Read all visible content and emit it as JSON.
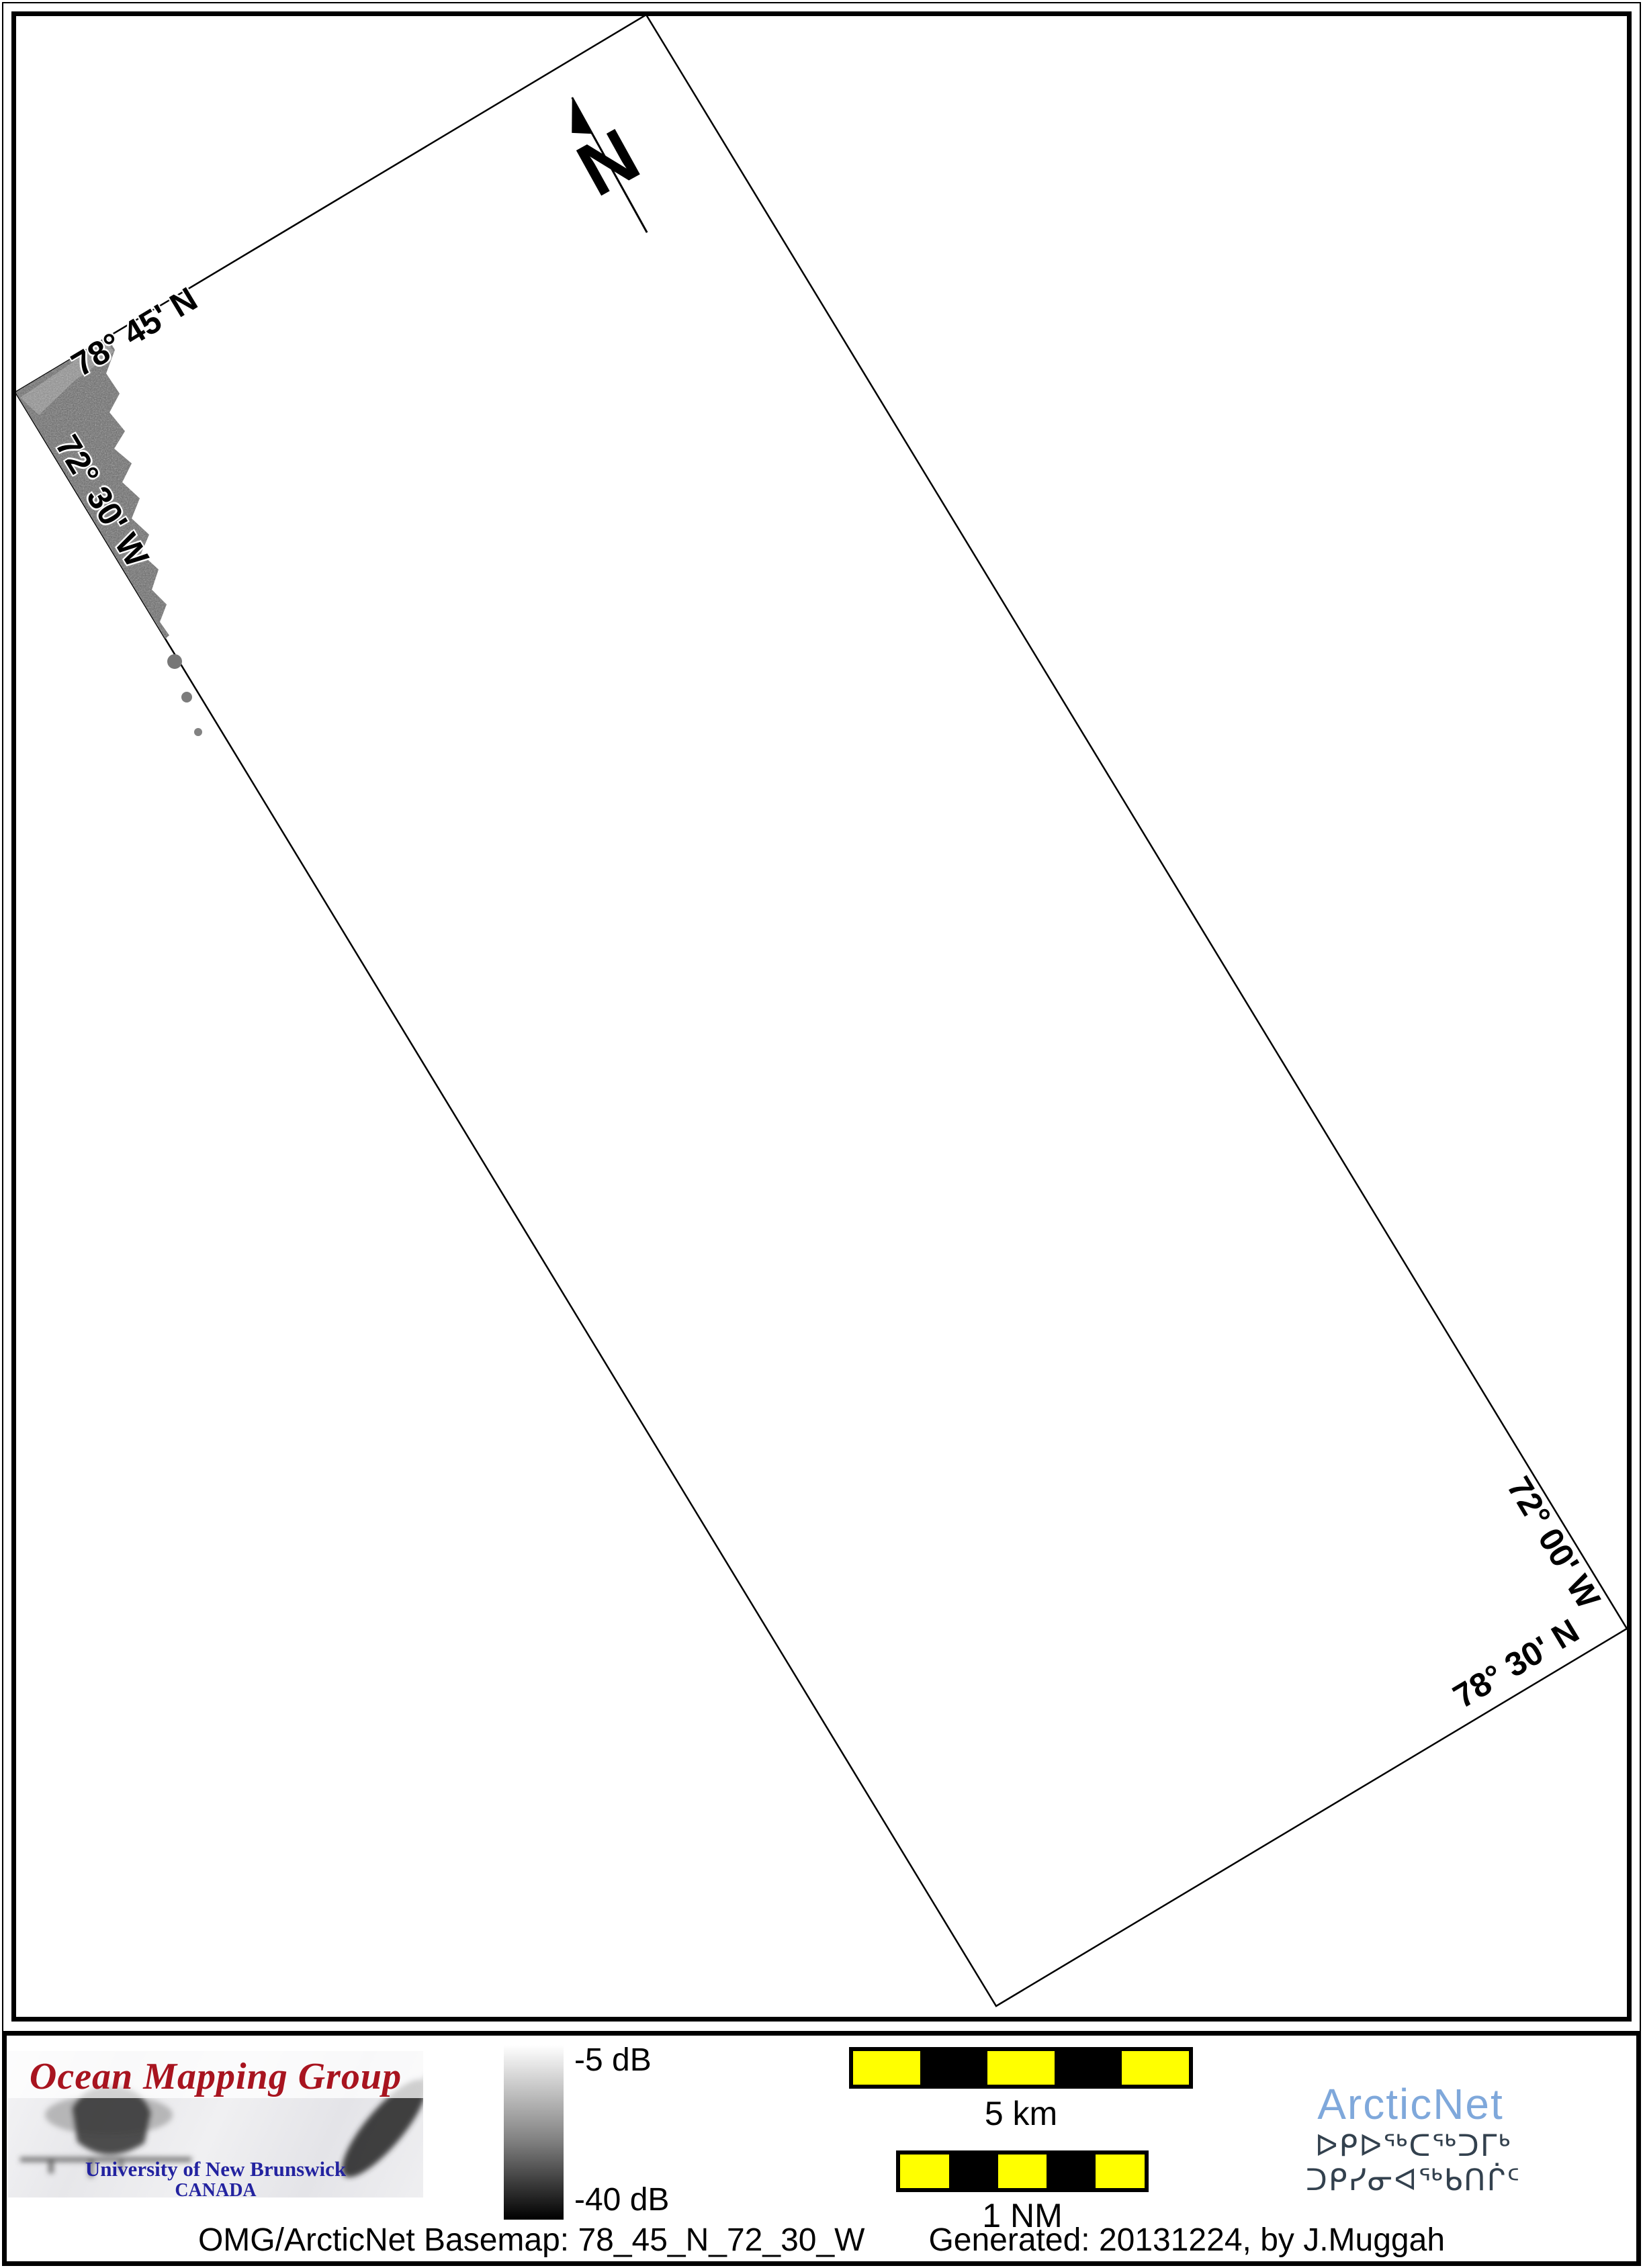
{
  "map": {
    "edge_labels": {
      "top_left_lat": "78° 45' N",
      "top_left_lon": "72° 30' W",
      "bottom_right_lon": "72° 00' W",
      "bottom_right_lat": "78° 30' N"
    },
    "north_arrow_letter": "N"
  },
  "legend": {
    "omg": {
      "title": "Ocean Mapping Group",
      "university": "University of New Brunswick",
      "country": "CANADA",
      "title_color": "#a8141f",
      "text_color": "#2323a0"
    },
    "colorbar": {
      "top_label": "-5 dB",
      "bottom_label": "-40 dB",
      "top_value": -5,
      "bottom_value": -40,
      "units": "dB",
      "gradient_top": "#ffffff",
      "gradient_bottom": "#000000"
    },
    "scalebars": {
      "km": {
        "label": "5 km",
        "segments": 5
      },
      "nm": {
        "label": "1 NM",
        "segments": 5
      },
      "segment_yellow": "#ffff00",
      "segment_black": "#000000"
    },
    "arcticnet": {
      "name": "ArcticNet",
      "inuktitut": "ᐅᑭᐅᖅᑕᖅᑐᒥᒃ ᑐᑭᓯᓂᐊᖅᑲᑎᒌᑦ",
      "name_color": "#7fa8db",
      "inuktitut_color": "#33414e"
    },
    "footer": {
      "basemap": "OMG/ArcticNet Basemap: 78_45_N_72_30_W",
      "generated": "Generated: 20131224, by J.Muggah"
    }
  }
}
